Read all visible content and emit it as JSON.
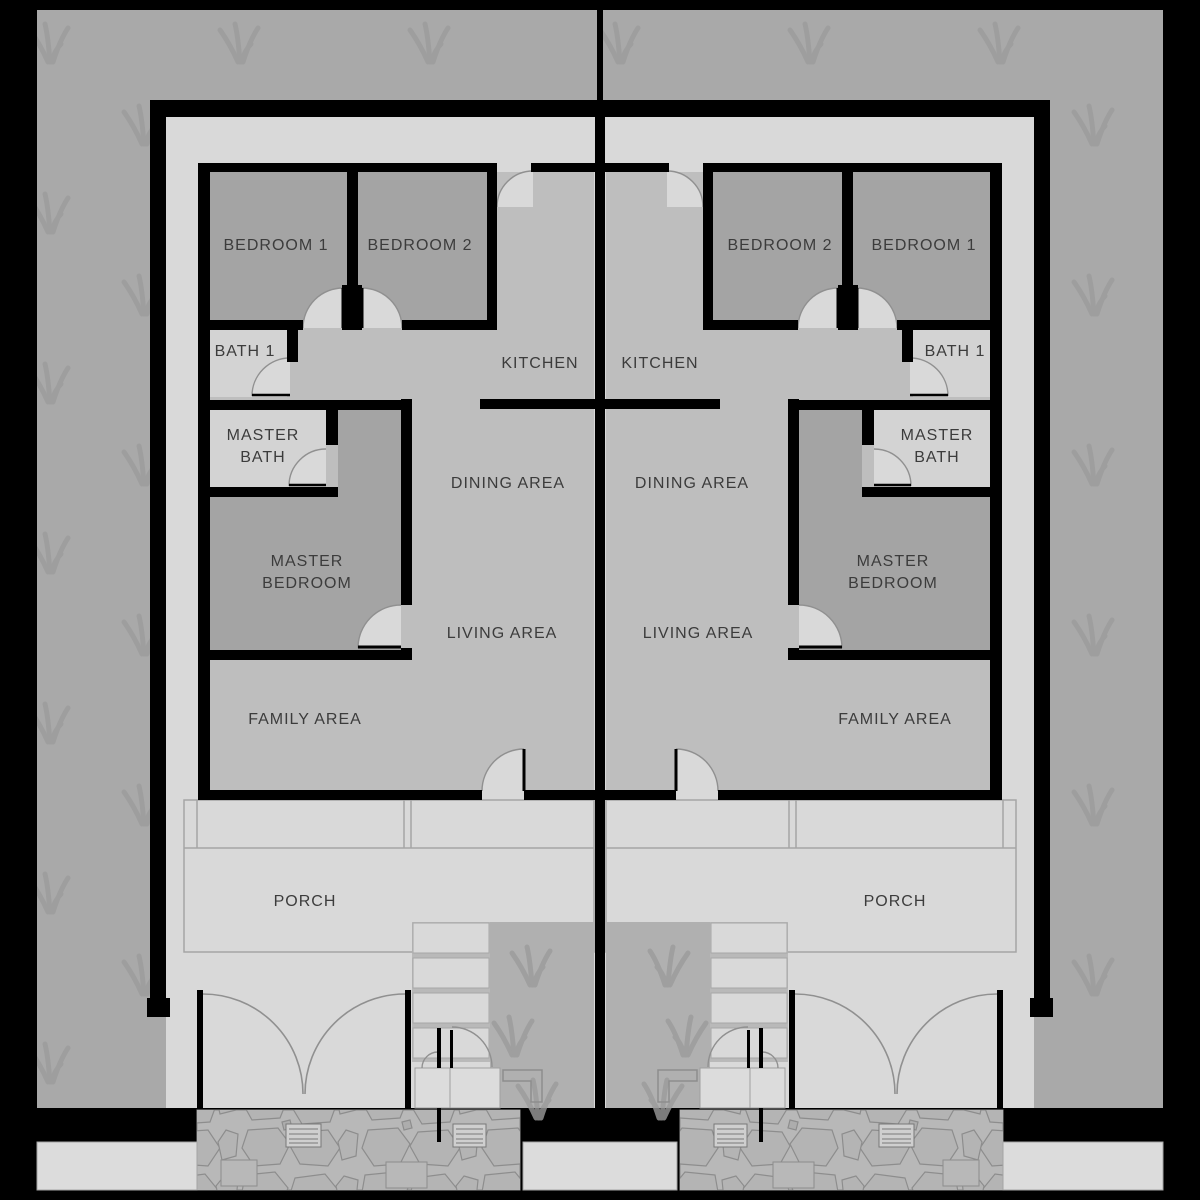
{
  "floor_plan": {
    "type": "duplex-floor-plan",
    "units": {
      "left": {
        "bedroom1": "BEDROOM 1",
        "bedroom2": "BEDROOM 2",
        "bath1": "BATH 1",
        "master_bath": [
          "MASTER",
          "BATH"
        ],
        "master_bedroom": [
          "MASTER",
          "BEDROOM"
        ],
        "kitchen": "KITCHEN",
        "dining": "DINING AREA",
        "living": "LIVING AREA",
        "family": "FAMILY AREA",
        "porch": "PORCH"
      },
      "right": {
        "bedroom1": "BEDROOM 1",
        "bedroom2": "BEDROOM 2",
        "bath1": "BATH 1",
        "master_bath": [
          "MASTER",
          "BATH"
        ],
        "master_bedroom": [
          "MASTER",
          "BEDROOM"
        ],
        "kitchen": "KITCHEN",
        "dining": "DINING AREA",
        "living": "LIVING AREA",
        "family": "FAMILY AREA",
        "porch": "PORCH"
      }
    },
    "colors": {
      "wall": "#000000",
      "lawn": "#a9a9a9",
      "lawn_tuft": "#9b9b9b",
      "interior_light": "#d9d9d9",
      "open_area": "#bebebe",
      "bedroom": "#a4a4a4",
      "bath": "#d3d3d3",
      "stone_path": "#b8b8b8",
      "sidewalk": "#dcdcdc",
      "label_text": "#3c3c3c"
    }
  }
}
